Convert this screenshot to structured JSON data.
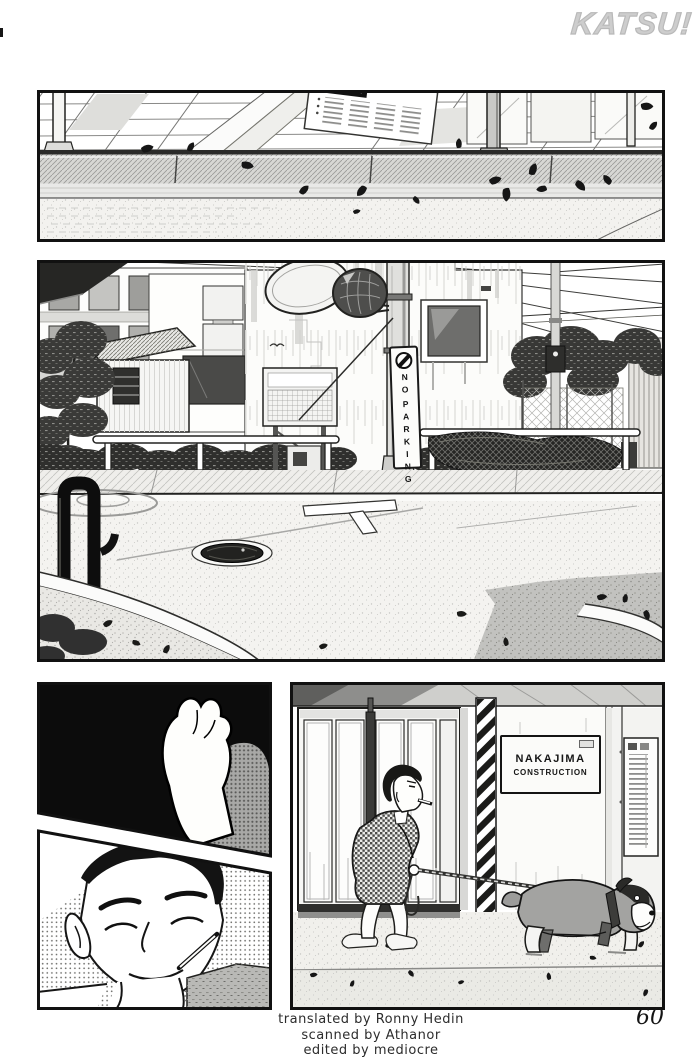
{
  "page": {
    "logo_text": "KATSU!",
    "page_number": "60"
  },
  "credits": {
    "line1": "translated by Ronny Hedin",
    "line2": "scanned by Athanor",
    "line3": "edited by mediocre"
  },
  "signs": {
    "no_parking": {
      "symbol": "no-parking-circle-icon",
      "line1": "NO",
      "line2": "PARKING"
    },
    "construction": {
      "line1": "NAKAJIMA",
      "line2": "CONSTRUCTION"
    }
  },
  "panels": [
    {
      "id": "panel-1",
      "content": "sidewalk curb with scattered fallen leaves and a posted notice"
    },
    {
      "id": "panel-2",
      "content": "street corner with utility pole, no-parking sign, convex mirrors, hedges, guardrails and manhole"
    },
    {
      "id": "panel-3",
      "content": "close-up of a dog paw raised against black"
    },
    {
      "id": "panel-4",
      "content": "smiling young man with a toothpick in his mouth"
    },
    {
      "id": "panel-5",
      "content": "man in patterned jacket walking a bulldog on a leash past Nakajima Construction"
    }
  ],
  "colors": {
    "paper": "#ffffff",
    "ink": "#161616",
    "logo_gray": "#cdcdcd",
    "panel_black": "#0c0c0c",
    "midtone_gray": "#a3a3a1"
  }
}
